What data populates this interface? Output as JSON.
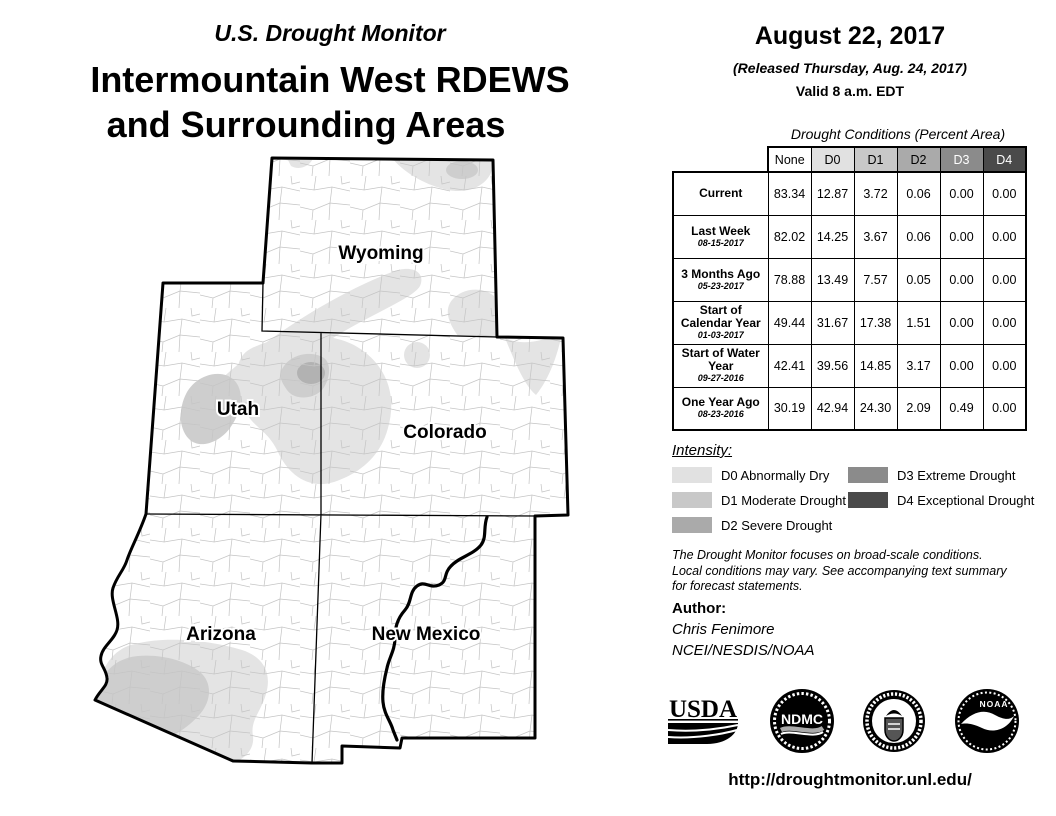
{
  "title": {
    "supertitle": "U.S. Drought Monitor",
    "line1": "Intermountain West RDEWS",
    "line2": "and Surrounding Areas"
  },
  "release": {
    "date": "August 22, 2017",
    "released": "(Released Thursday, Aug. 24, 2017)",
    "valid": "Valid 8 a.m. EDT"
  },
  "map": {
    "state_labels": {
      "wyoming": "Wyoming",
      "utah": "Utah",
      "colorado": "Colorado",
      "arizona": "Arizona",
      "new_mexico": "New Mexico"
    }
  },
  "table": {
    "caption": "Drought Conditions (Percent Area)",
    "columns": [
      "None",
      "D0",
      "D1",
      "D2",
      "D3",
      "D4"
    ],
    "rows": [
      {
        "label": "Current",
        "date": "",
        "values": [
          "83.34",
          "12.87",
          "3.72",
          "0.06",
          "0.00",
          "0.00"
        ]
      },
      {
        "label": "Last Week",
        "date": "08-15-2017",
        "values": [
          "82.02",
          "14.25",
          "3.67",
          "0.06",
          "0.00",
          "0.00"
        ]
      },
      {
        "label": "3 Months Ago",
        "date": "05-23-2017",
        "values": [
          "78.88",
          "13.49",
          "7.57",
          "0.05",
          "0.00",
          "0.00"
        ]
      },
      {
        "label": "Start of Calendar Year",
        "date": "01-03-2017",
        "values": [
          "49.44",
          "31.67",
          "17.38",
          "1.51",
          "0.00",
          "0.00"
        ]
      },
      {
        "label": "Start of Water Year",
        "date": "09-27-2016",
        "values": [
          "42.41",
          "39.56",
          "14.85",
          "3.17",
          "0.00",
          "0.00"
        ]
      },
      {
        "label": "One Year Ago",
        "date": "08-23-2016",
        "values": [
          "30.19",
          "42.94",
          "24.30",
          "2.09",
          "0.49",
          "0.00"
        ]
      }
    ]
  },
  "legend": {
    "heading": "Intensity:",
    "items": [
      {
        "code": "D0",
        "label": "D0 Abnormally Dry",
        "color": "#e1e1e1"
      },
      {
        "code": "D1",
        "label": "D1 Moderate Drought",
        "color": "#c8c8c8"
      },
      {
        "code": "D2",
        "label": "D2 Severe Drought",
        "color": "#aaaaaa"
      },
      {
        "code": "D3",
        "label": "D3 Extreme Drought",
        "color": "#8b8b8b"
      },
      {
        "code": "D4",
        "label": "D4 Exceptional Drought",
        "color": "#4a4a4a"
      }
    ]
  },
  "notes": {
    "lines": [
      "The Drought Monitor focuses on broad-scale conditions.",
      "Local conditions may vary. See accompanying text summary",
      "for forecast statements."
    ]
  },
  "author": {
    "heading": "Author:",
    "name": "Chris Fenimore",
    "org": "NCEI/NESDIS/NOAA"
  },
  "logos": [
    {
      "name": "USDA",
      "text": "USDA"
    },
    {
      "name": "NDMC",
      "text": "NDMC"
    },
    {
      "name": "U.S. Department of Commerce",
      "text": ""
    },
    {
      "name": "NOAA",
      "text": "NOAA"
    }
  ],
  "footer": {
    "url": "http://droughtmonitor.unl.edu/"
  },
  "chart_data": {
    "type": "table",
    "title": "Drought Conditions (Percent Area)",
    "columns": [
      "None",
      "D0",
      "D1",
      "D2",
      "D3",
      "D4"
    ],
    "rows": [
      {
        "period": "Current",
        "values": [
          83.34,
          12.87,
          3.72,
          0.06,
          0.0,
          0.0
        ]
      },
      {
        "period": "Last Week 08-15-2017",
        "values": [
          82.02,
          14.25,
          3.67,
          0.06,
          0.0,
          0.0
        ]
      },
      {
        "period": "3 Months Ago 05-23-2017",
        "values": [
          78.88,
          13.49,
          7.57,
          0.05,
          0.0,
          0.0
        ]
      },
      {
        "period": "Start of Calendar Year 01-03-2017",
        "values": [
          49.44,
          31.67,
          17.38,
          1.51,
          0.0,
          0.0
        ]
      },
      {
        "period": "Start of Water Year 09-27-2016",
        "values": [
          42.41,
          39.56,
          14.85,
          3.17,
          0.0,
          0.0
        ]
      },
      {
        "period": "One Year Ago 08-23-2016",
        "values": [
          30.19,
          42.94,
          24.3,
          2.09,
          0.49,
          0.0
        ]
      }
    ]
  }
}
